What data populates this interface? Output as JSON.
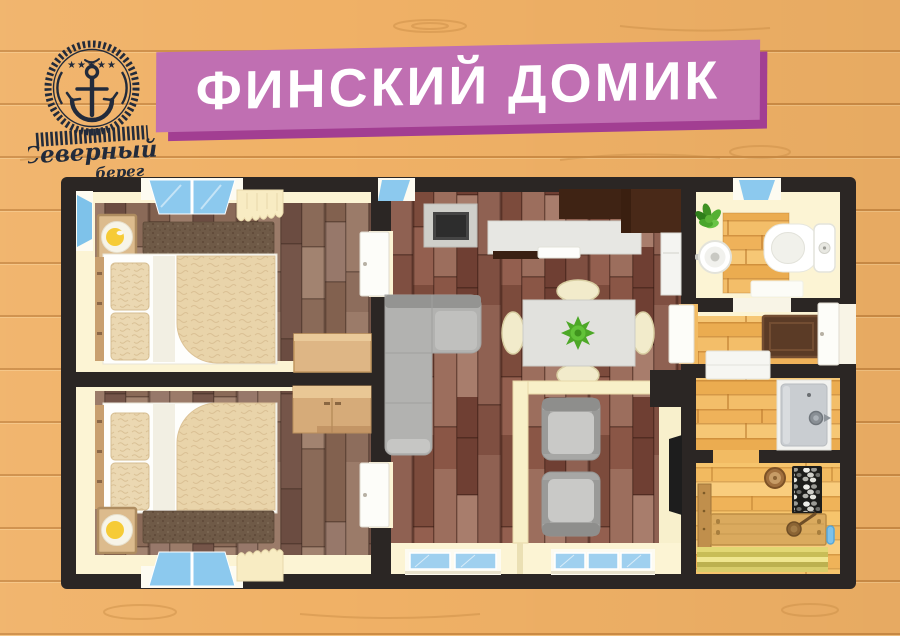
{
  "poster": {
    "width": 900,
    "height": 636,
    "background": {
      "wood_base": "#F0B166",
      "plank_line": "#C98F45",
      "grain": "#D1944A"
    }
  },
  "logo": {
    "line1": "Северный",
    "line2": "берег",
    "stars": "★★★★★",
    "ink": "#222B3B",
    "elements": [
      "rope-ring",
      "five-stars",
      "anchor-icon",
      "rope-band",
      "script-name"
    ]
  },
  "banner": {
    "title": "ФИНСКИЙ ДОМИК",
    "fill": "#C06FB2",
    "shadow": "#A23E92",
    "text_color": "#FFFFFF"
  },
  "floorplan": {
    "palette": {
      "wall": "#2B2624",
      "floor_cream": "#FCF4D4",
      "bedroom_plank": "#8A6A58",
      "living_plank": "#8D5D4D",
      "light_plank": "#F2BB63",
      "sauna_plank": "#F5C46F",
      "window_glass": "#8CC9EE",
      "door_white": "#FDFDF9",
      "sofa_gray": "#B2B2B0",
      "kitchen_cabinet_dark": "#3F2314",
      "counter_gray": "#E7E7E3",
      "wood_furniture_tan": "#DEB685",
      "curtain_cream": "#F8ECC3",
      "doormat_brown": "#5B3B26",
      "plant_green": "#4DA827"
    },
    "rooms": [
      {
        "name": "bedroom-top-left",
        "furniture": [
          "double-bed",
          "two-pillows",
          "duvet",
          "dark-throw",
          "bedside-lamp-table",
          "dresser",
          "top-window",
          "left-window",
          "curtain",
          "door-to-living"
        ]
      },
      {
        "name": "bedroom-bottom-left",
        "furniture": [
          "double-bed",
          "two-pillows",
          "duvet",
          "dark-throw",
          "bedside-lamp-table",
          "wardrobe",
          "bottom-window",
          "curtain",
          "door-to-living"
        ]
      },
      {
        "name": "living-room-kitchen",
        "furniture": [
          "corner-sofa",
          "dining-table",
          "four-chairs",
          "table-plant",
          "tv-on-stand",
          "kitchen-cabinets",
          "counter-with-sink",
          "fridge",
          "small-window",
          "bottom-windows"
        ]
      },
      {
        "name": "veranda-lounge",
        "furniture": [
          "armchair",
          "armchair",
          "wall-tv",
          "log-partition",
          "bottom-windows"
        ]
      },
      {
        "name": "bathroom",
        "furniture": [
          "round-sink",
          "toilet-with-tank",
          "potted-plant",
          "wooden-mat",
          "white-bath-mat",
          "window",
          "door-to-hall"
        ]
      },
      {
        "name": "entrance-hall",
        "furniture": [
          "doormat",
          "entrance-door",
          "door-to-living"
        ]
      },
      {
        "name": "shower-room",
        "furniture": [
          "shower-cabin-with-handle",
          "sliding-door"
        ]
      },
      {
        "name": "sauna",
        "furniture": [
          "stove-with-stones",
          "wall-bench",
          "main-bench",
          "wooden-bucket",
          "ladle",
          "slat-bench",
          "thermometer"
        ]
      }
    ]
  }
}
